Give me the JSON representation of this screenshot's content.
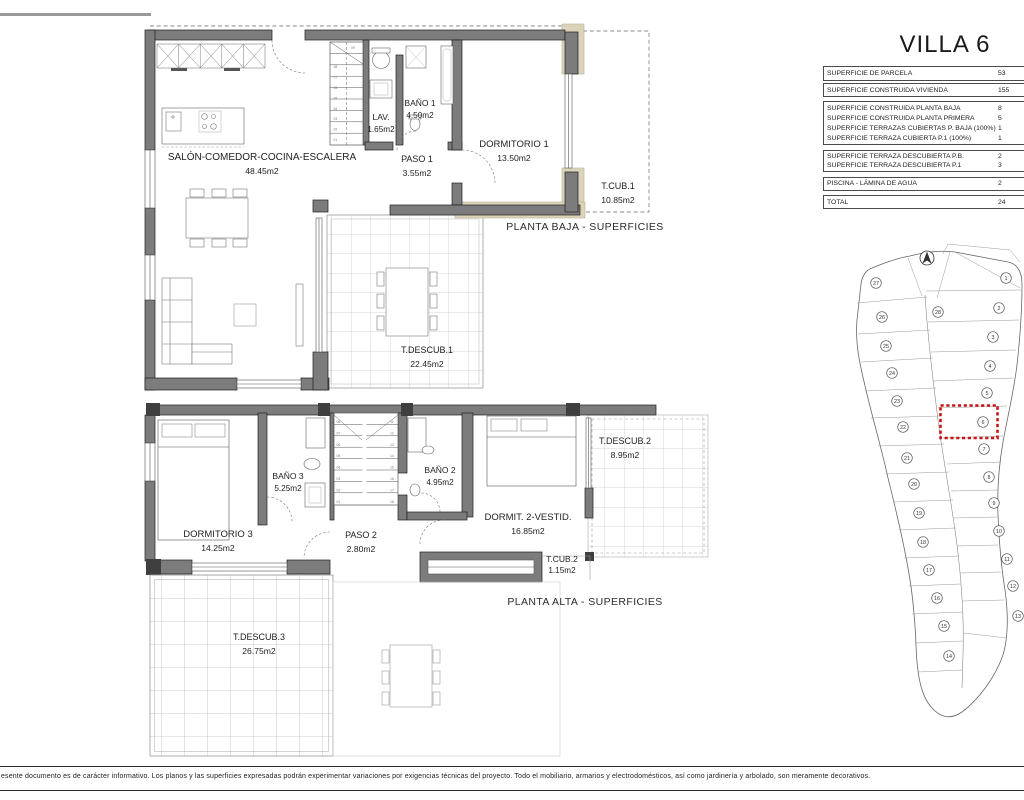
{
  "title": "VILLA 6",
  "table": {
    "rows": [
      {
        "label": "SUPERFICIE DE PARCELA",
        "value": "53"
      },
      {
        "label": "SUPERFICIE CONSTRUIDA VIVIENDA",
        "value": "155"
      },
      {
        "label": "SUPERFICIE CONSTRUIDA PLANTA BAJA",
        "value": "8"
      },
      {
        "label": "SUPERFICIE CONSTRUIDA PLANTA PRIMERA",
        "value": "5"
      },
      {
        "label": "SUPERFICIE TERRAZAS CUBIERTAS P. BAJA (100%)",
        "value": "1"
      },
      {
        "label": "SUPERFICIE TERRAZA CUBIERTA P.1 (100%)",
        "value": "1"
      },
      {
        "label": "SUPERFICIE TERRAZA DESCUBIERTA P.B.",
        "value": "2"
      },
      {
        "label": "SUPERFICIE TERRAZA DESCUBIERTA P.1",
        "value": "3"
      },
      {
        "label": "PISCINA - LÁMINA DE AGUA",
        "value": "2"
      },
      {
        "label": "TOTAL",
        "value": "24"
      }
    ]
  },
  "plans": {
    "baja": {
      "caption": "PLANTA BAJA - SUPERFICIES",
      "rooms": {
        "salon": {
          "name": "SALÓN-COMEDOR-COCINA-ESCALERA",
          "area": "48.45m2"
        },
        "lav": {
          "name": "LAV.",
          "area": "1.65m2"
        },
        "bano1": {
          "name": "BAÑO 1",
          "area": "4.50m2"
        },
        "paso1": {
          "name": "PASO 1",
          "area": "3.55m2"
        },
        "dormitorio1": {
          "name": "DORMITORIO 1",
          "area": "13.50m2"
        },
        "tcub1": {
          "name": "T.CUB.1",
          "area": "10.85m2"
        },
        "tdescub1": {
          "name": "T.DESCUB.1",
          "area": "22.45m2"
        }
      }
    },
    "alta": {
      "caption": "PLANTA ALTA - SUPERFICIES",
      "rooms": {
        "dormitorio3": {
          "name": "DORMITORIO 3",
          "area": "14.25m2"
        },
        "bano3": {
          "name": "BAÑO 3",
          "area": "5.25m2"
        },
        "paso2": {
          "name": "PASO 2",
          "area": "2.80m2"
        },
        "bano2": {
          "name": "BAÑO 2",
          "area": "4.95m2"
        },
        "dormitorio2": {
          "name": "DORMIT. 2-VESTID.",
          "area": "16.85m2"
        },
        "tcub2": {
          "name": "T.CUB.2",
          "area": "1.15m2"
        },
        "tdescub2": {
          "name": "T.DESCUB.2",
          "area": "8.95m2"
        },
        "tdescub3": {
          "name": "T.DESCUB.3",
          "area": "26.75m2"
        }
      }
    }
  },
  "stairs": {
    "baja": [
      "01",
      "02",
      "03",
      "04",
      "05",
      "06",
      "07",
      "08",
      "09"
    ],
    "alta_left": [
      "08",
      "07",
      "06",
      "05",
      "04",
      "03",
      "02",
      "01"
    ],
    "alta_right": [
      "11",
      "12",
      "13",
      "14",
      "15",
      "16",
      "17",
      "18"
    ]
  },
  "siteplan": {
    "plots": [
      "1",
      "2",
      "3",
      "4",
      "5",
      "6",
      "7",
      "8",
      "9",
      "10",
      "11",
      "12",
      "13",
      "14",
      "15",
      "16",
      "17",
      "18",
      "19",
      "20",
      "21",
      "22",
      "23",
      "24",
      "25",
      "26",
      "27",
      "28"
    ],
    "highlighted_plot": "6",
    "highlight_color": "#c81414"
  },
  "disclaimer": "esente documento es de carácter informativo. Los planos y las superficies expresadas podrán experimentar variaciones por exigencias técnicas del proyecto. Todo el mobiliario, armarios y electrodomésticos, así como jardinería y arbolado, son meramente decorativos.",
  "colors": {
    "wall": "#7c7c7c",
    "pillar_tan": "#dcd4ba",
    "terrace_grid": "#c6c6c6",
    "highlight_red": "#c81414",
    "line": "#222222"
  }
}
